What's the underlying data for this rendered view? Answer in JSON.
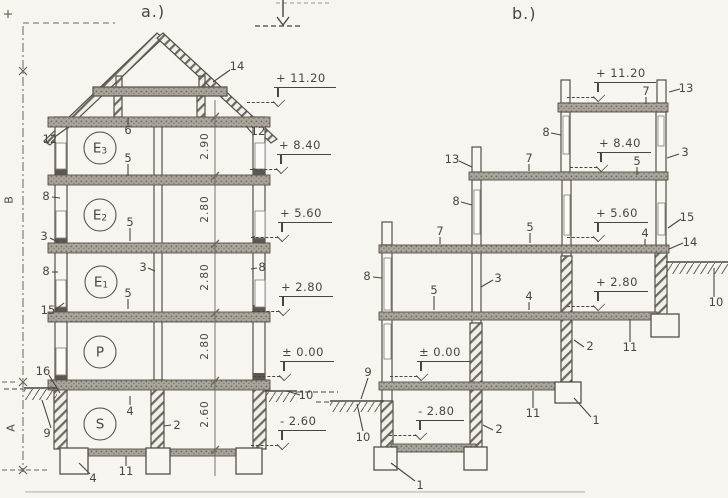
{
  "drawing": {
    "type": "scanned building cross-sections",
    "colors": {
      "paper": "#f6f5f0",
      "ink": "#4a463f",
      "slab": "#aaa59b",
      "hatch": "#6e6960"
    },
    "section_a": {
      "title": {
        "t": "a.)",
        "x": 141,
        "y": 2
      },
      "rooms": [
        {
          "main": "E",
          "sub": "3",
          "x": 100,
          "y": 148
        },
        {
          "main": "E",
          "sub": "2",
          "x": 100,
          "y": 215
        },
        {
          "main": "E",
          "sub": "1",
          "x": 101,
          "y": 282
        },
        {
          "main": "P",
          "sub": "",
          "x": 100,
          "y": 352
        },
        {
          "main": "S",
          "sub": "",
          "x": 100,
          "y": 424
        }
      ],
      "dims": [
        {
          "t": "2.90",
          "x": 205,
          "y": 146
        },
        {
          "t": "2.80",
          "x": 205,
          "y": 209
        },
        {
          "t": "2.80",
          "x": 205,
          "y": 277
        },
        {
          "t": "2.80",
          "x": 205,
          "y": 346
        },
        {
          "t": "2.60",
          "x": 205,
          "y": 414
        }
      ],
      "levels": [
        {
          "t": "+ 11.20",
          "x": 274,
          "y": 71
        },
        {
          "t": "+ 8.40",
          "x": 277,
          "y": 138
        },
        {
          "t": "+ 5.60",
          "x": 278,
          "y": 206
        },
        {
          "t": "+ 2.80",
          "x": 279,
          "y": 280
        },
        {
          "t": "± 0.00",
          "x": 280,
          "y": 345
        },
        {
          "t": "- 2.60",
          "x": 278,
          "y": 414
        }
      ],
      "callouts": [
        {
          "t": "14",
          "x": 237,
          "y": 66
        },
        {
          "t": "12",
          "x": 50,
          "y": 139
        },
        {
          "t": "12",
          "x": 258,
          "y": 131
        },
        {
          "t": "6",
          "x": 128,
          "y": 130
        },
        {
          "t": "5",
          "x": 128,
          "y": 158
        },
        {
          "t": "8",
          "x": 46,
          "y": 196
        },
        {
          "t": "3",
          "x": 44,
          "y": 236
        },
        {
          "t": "5",
          "x": 130,
          "y": 222
        },
        {
          "t": "8",
          "x": 46,
          "y": 271
        },
        {
          "t": "8",
          "x": 262,
          "y": 267
        },
        {
          "t": "3",
          "x": 143,
          "y": 267
        },
        {
          "t": "5",
          "x": 128,
          "y": 293
        },
        {
          "t": "15",
          "x": 48,
          "y": 310
        },
        {
          "t": "16",
          "x": 43,
          "y": 371
        },
        {
          "t": "4",
          "x": 130,
          "y": 411
        },
        {
          "t": "2",
          "x": 177,
          "y": 425
        },
        {
          "t": "9",
          "x": 47,
          "y": 433
        },
        {
          "t": "10",
          "x": 306,
          "y": 395
        },
        {
          "t": "4",
          "x": 93,
          "y": 478
        },
        {
          "t": "11",
          "x": 126,
          "y": 471
        }
      ],
      "axis_letters": [
        {
          "t": "B",
          "x": 9,
          "y": 200
        },
        {
          "t": "A",
          "x": 11,
          "y": 428
        }
      ]
    },
    "section_b": {
      "title": {
        "t": "b.)",
        "x": 512,
        "y": 4
      },
      "levels": [
        {
          "t": "+ 11.20",
          "x": 594,
          "y": 66
        },
        {
          "t": "+ 8.40",
          "x": 597,
          "y": 136
        },
        {
          "t": "+ 5.60",
          "x": 594,
          "y": 206
        },
        {
          "t": "+ 2.80",
          "x": 594,
          "y": 275
        },
        {
          "t": "± 0.00",
          "x": 417,
          "y": 345
        },
        {
          "t": "- 2.80",
          "x": 416,
          "y": 404
        }
      ],
      "callouts": [
        {
          "t": "7",
          "x": 646,
          "y": 91
        },
        {
          "t": "13",
          "x": 686,
          "y": 88
        },
        {
          "t": "8",
          "x": 546,
          "y": 132
        },
        {
          "t": "13",
          "x": 452,
          "y": 159
        },
        {
          "t": "7",
          "x": 529,
          "y": 158
        },
        {
          "t": "5",
          "x": 637,
          "y": 161
        },
        {
          "t": "3",
          "x": 685,
          "y": 152
        },
        {
          "t": "8",
          "x": 456,
          "y": 201
        },
        {
          "t": "7",
          "x": 440,
          "y": 231
        },
        {
          "t": "5",
          "x": 530,
          "y": 227
        },
        {
          "t": "4",
          "x": 645,
          "y": 233
        },
        {
          "t": "15",
          "x": 687,
          "y": 217
        },
        {
          "t": "14",
          "x": 690,
          "y": 242
        },
        {
          "t": "8",
          "x": 367,
          "y": 276
        },
        {
          "t": "3",
          "x": 498,
          "y": 278
        },
        {
          "t": "5",
          "x": 434,
          "y": 290
        },
        {
          "t": "4",
          "x": 529,
          "y": 296
        },
        {
          "t": "10",
          "x": 716,
          "y": 302
        },
        {
          "t": "2",
          "x": 590,
          "y": 346
        },
        {
          "t": "11",
          "x": 630,
          "y": 347
        },
        {
          "t": "9",
          "x": 368,
          "y": 372
        },
        {
          "t": "10",
          "x": 363,
          "y": 437
        },
        {
          "t": "2",
          "x": 499,
          "y": 429
        },
        {
          "t": "11",
          "x": 533,
          "y": 413
        },
        {
          "t": "1",
          "x": 596,
          "y": 420
        },
        {
          "t": "1",
          "x": 420,
          "y": 485
        }
      ]
    }
  }
}
